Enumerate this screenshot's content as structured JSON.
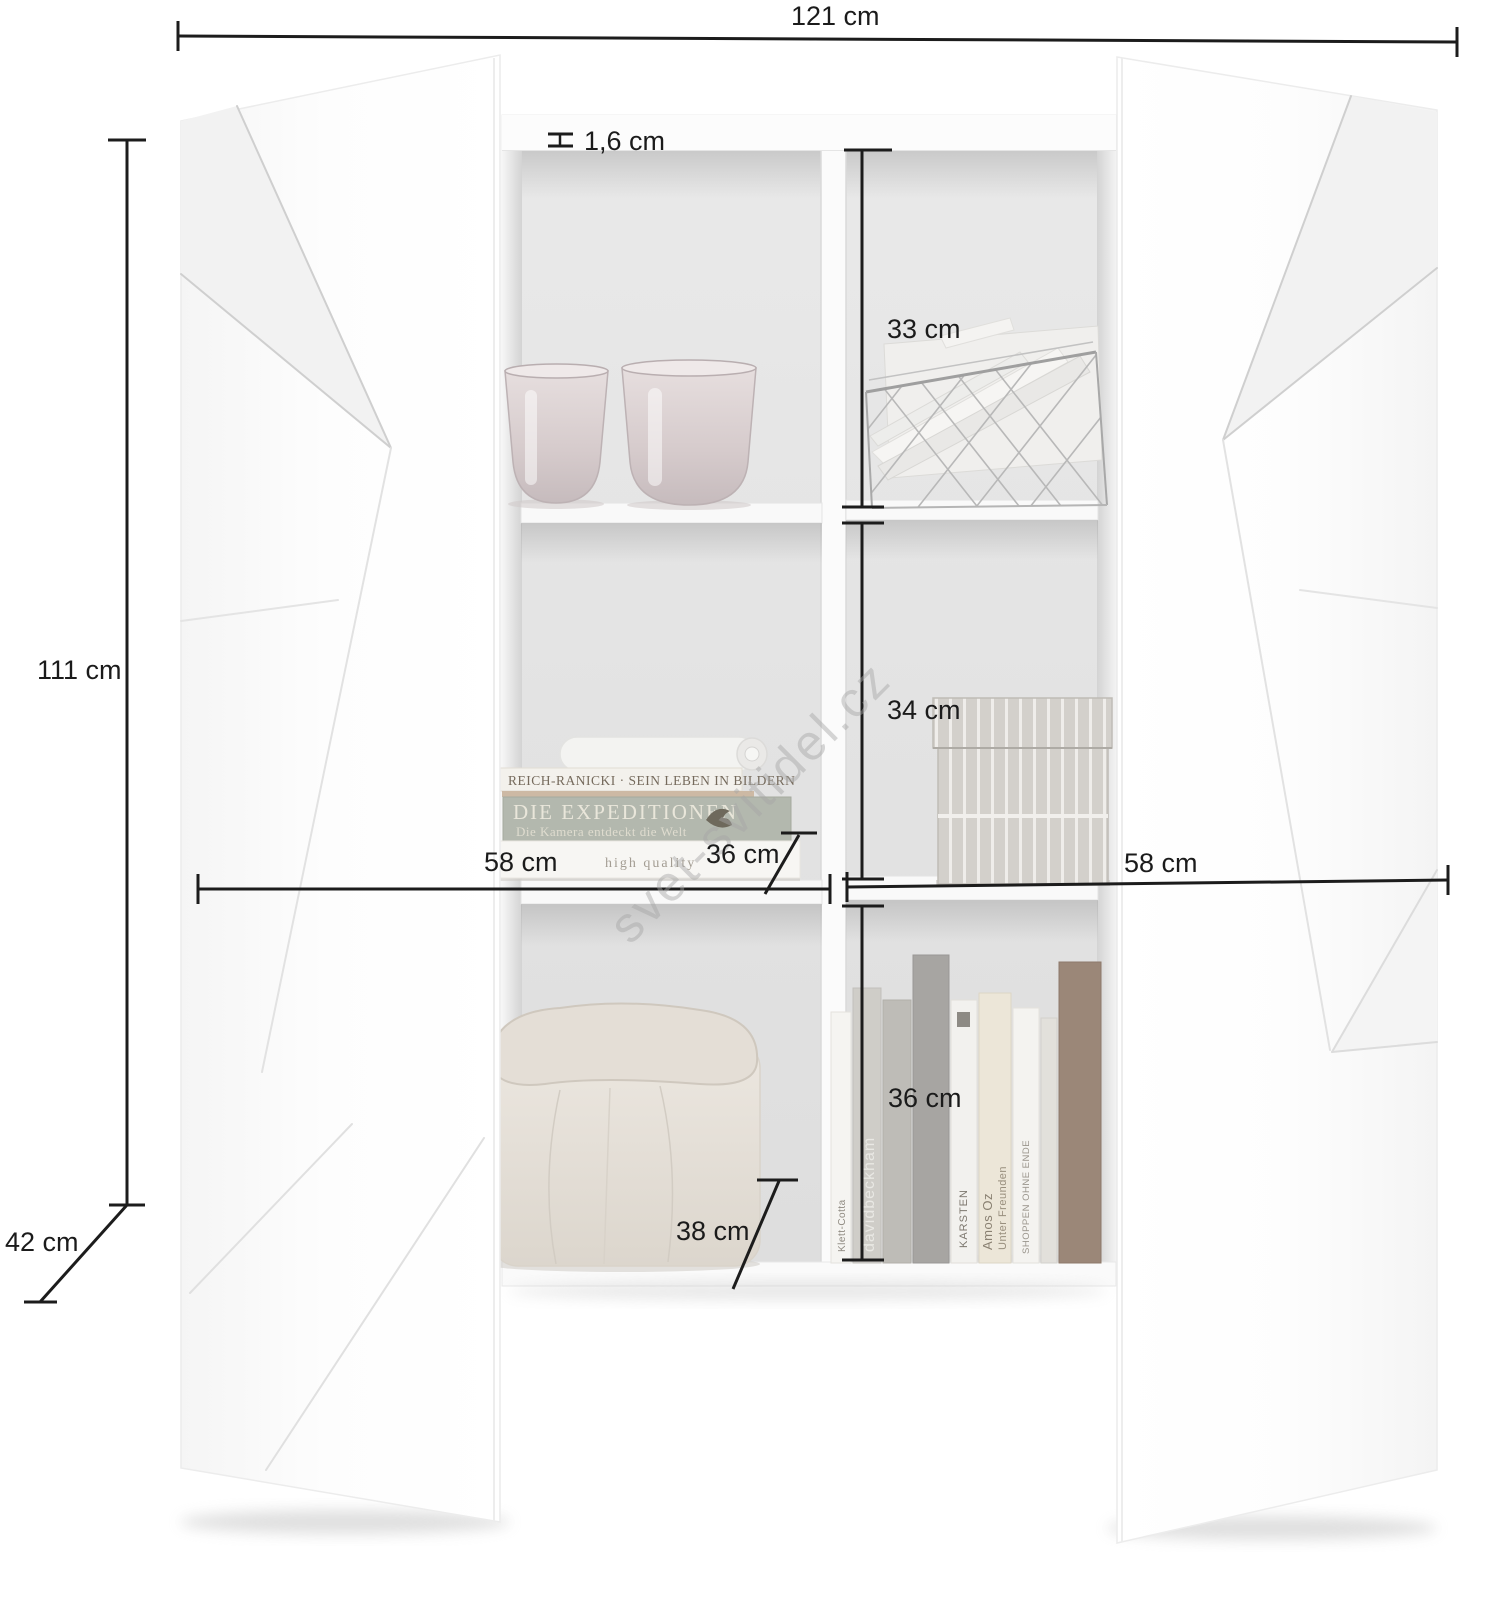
{
  "watermark": {
    "text": "svet-svitidel.cz"
  },
  "dimensions": {
    "total_width": "121 cm",
    "total_height": "111 cm",
    "total_depth": "42 cm",
    "panel_thickness": "1,6 cm",
    "top_compartment": "33 cm",
    "middle_compartment": "34 cm",
    "bottom_compartment": "36 cm",
    "left_width": "58 cm",
    "right_width": "58 cm",
    "middle_depth": "36 cm",
    "bottom_depth": "38 cm"
  },
  "decor": {
    "book_stack": {
      "spine_top": "REICH-RANICKI · SEIN LEBEN IN BILDERN",
      "spine_title": "DIE EXPEDITIONEN",
      "spine_subtitle": "Die Kamera entdeckt die Welt",
      "spine_bottom": "high quality"
    },
    "standing_books": {
      "spine_1": "Klett-Cotta",
      "spine_2": "davidbeckham",
      "spine_3": "KARSTEN",
      "spine_4": "Amos Oz",
      "spine_5": "Unter Freunden",
      "spine_6": "SHOPPEN OHNE ENDE"
    }
  },
  "icons": {
    "panel_thickness": "i-beam-caliper-icon"
  },
  "colors": {
    "dimension_line": "#1c1c1c",
    "interior_gray": "#e4e4e4",
    "door_white": "#fcfcfc",
    "watermark_gray": "#a6a6a6"
  }
}
